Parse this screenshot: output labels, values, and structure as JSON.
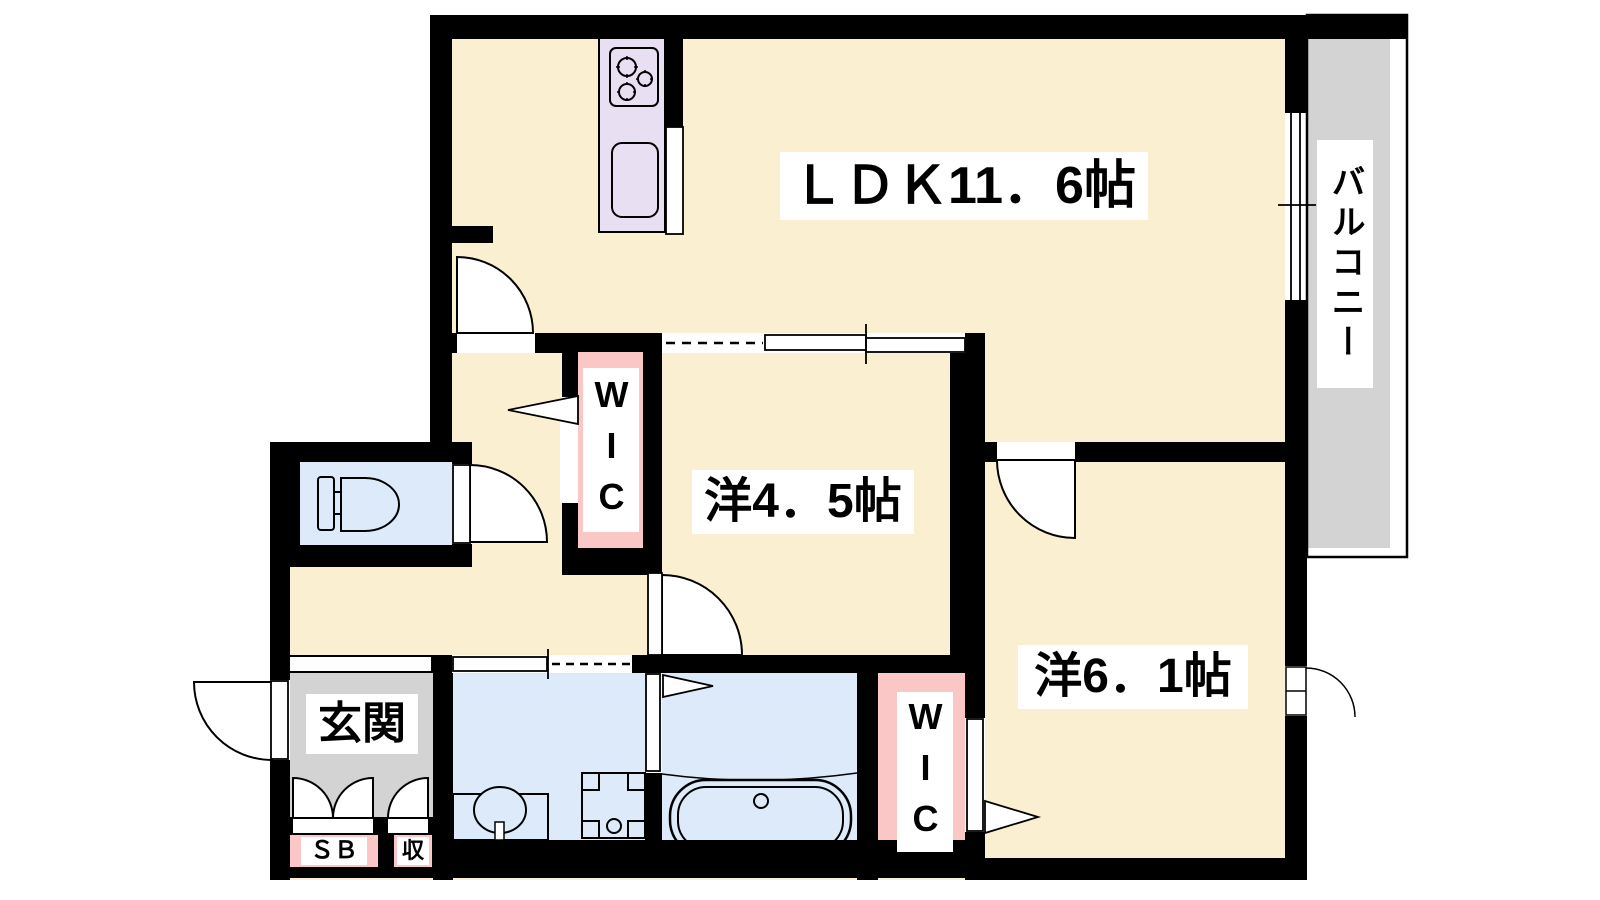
{
  "rooms": {
    "ldk": {
      "label": "ＬＤＫ11．6帖"
    },
    "western_room_4_5": {
      "label": "洋4．5帖"
    },
    "western_room_6_1": {
      "label": "洋6．1帖"
    },
    "balcony": {
      "label": "バルコニー"
    },
    "entrance": {
      "label": "玄関"
    },
    "wic_1": {
      "label": "WIC"
    },
    "wic_2": {
      "label": "WIC"
    },
    "shoe_box": {
      "label": "ＳＢ"
    },
    "storage": {
      "label": "収"
    }
  },
  "colors": {
    "wall": "#000000",
    "floor": "#FBEFD1",
    "kitchen_counter": "#E8DFF3",
    "closet": "#FAC6C6",
    "wet_area": "#DCEAFA",
    "outdoor": "#D3D3D3",
    "label_background": "#FFFFFF",
    "line": "#000000"
  }
}
